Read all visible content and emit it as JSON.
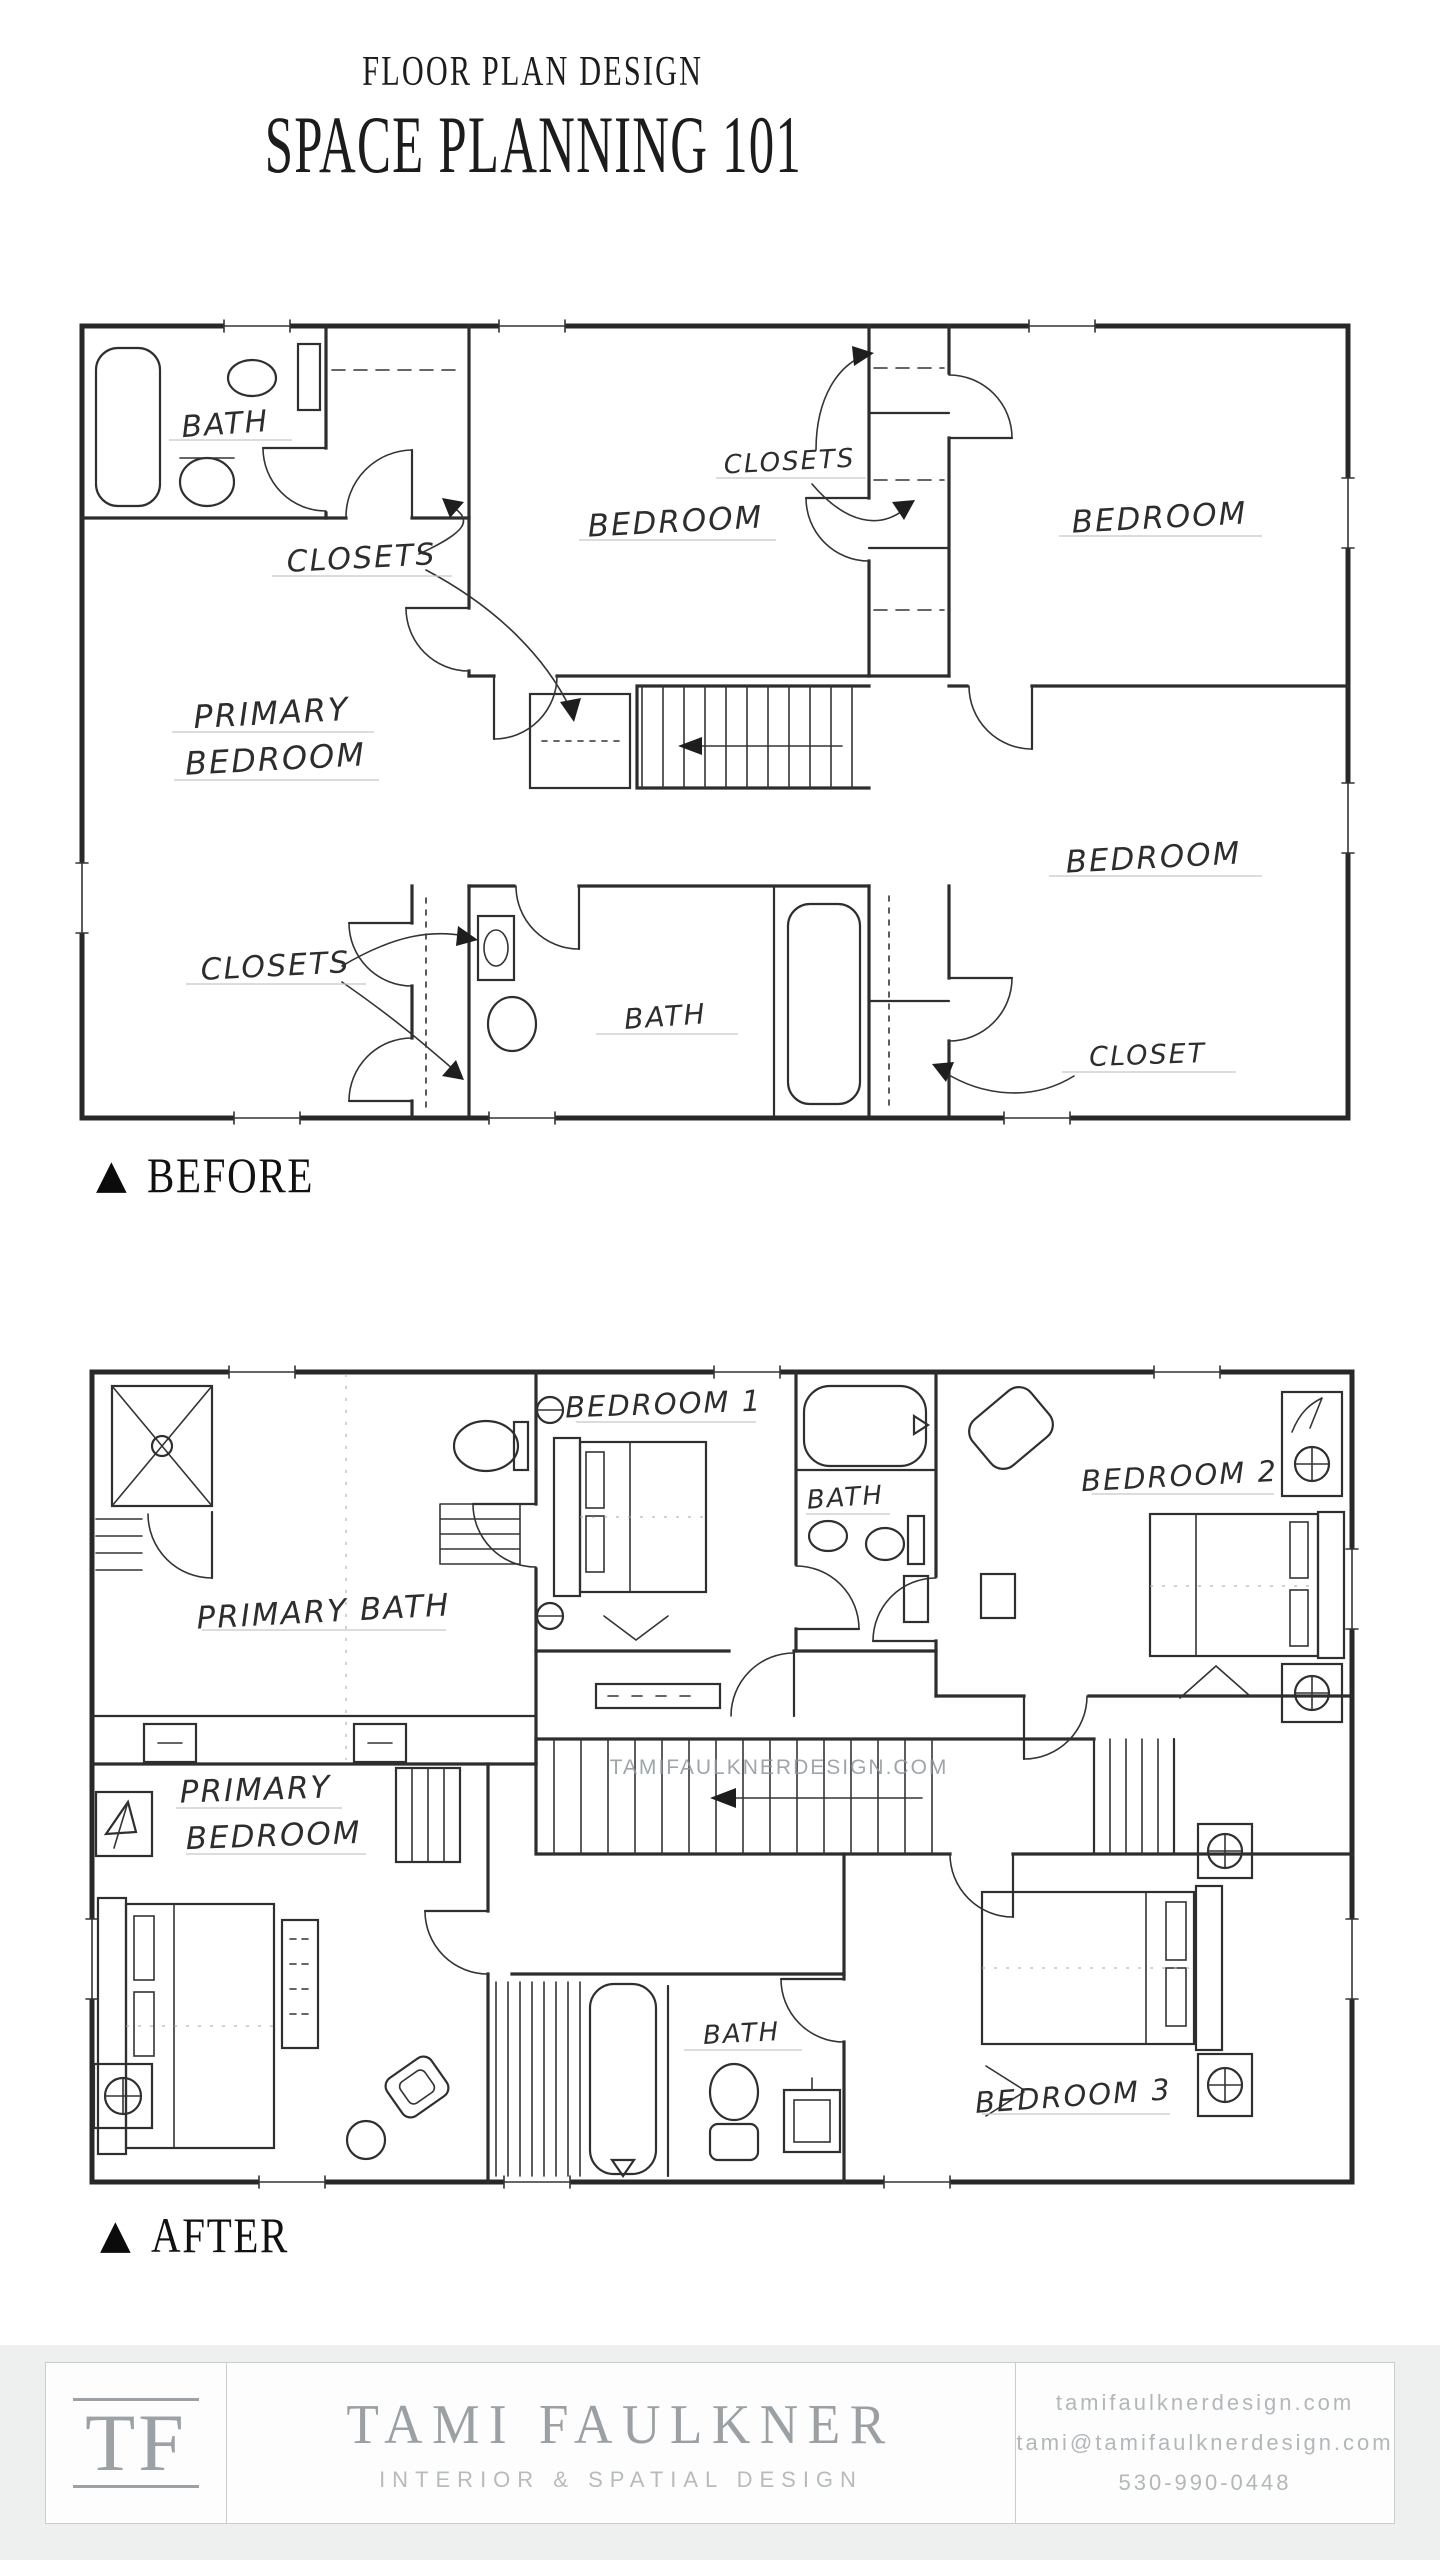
{
  "header": {
    "kicker": "FLOOR PLAN DESIGN",
    "title": "SPACE PLANNING 101"
  },
  "before": {
    "marker": "▲",
    "label": "BEFORE",
    "rooms": {
      "bath_top": "BATH",
      "closets_top_left": "CLOSETS",
      "bedroom_top_middle": "BEDROOM",
      "closets_center": "CLOSETS",
      "bedroom_top_right": "BEDROOM",
      "primary_line1": "PRIMARY",
      "primary_line2": "BEDROOM",
      "closets_bottom": "CLOSETS",
      "bath_bottom": "BATH",
      "bedroom_bottom_right": "BEDROOM",
      "closet_bottom_right": "CLOSET"
    }
  },
  "after": {
    "marker": "▲",
    "label": "AFTER",
    "watermark": "TAMIFAULKNERDESIGN.COM",
    "rooms": {
      "primary_bath": "PRIMARY BATH",
      "bedroom1": "BEDROOM 1",
      "bath_top": "BATH",
      "bedroom2": "BEDROOM 2",
      "primary_line1": "PRIMARY",
      "primary_line2": "BEDROOM",
      "bath_bottom": "BATH",
      "bedroom3": "BEDROOM 3"
    }
  },
  "footer": {
    "logo": "TF",
    "name": "TAMI FAULKNER",
    "tagline": "INTERIOR & SPATIAL DESIGN",
    "website": "tamifaulknerdesign.com",
    "email": "tami@tamifaulknerdesign.com",
    "phone": "530-990-0448"
  },
  "colors": {
    "plan_line": "#2d2d2d",
    "footer_text": "#9aa0a3",
    "footer_band": "#eef0ef",
    "watermark": "#8f979b"
  }
}
